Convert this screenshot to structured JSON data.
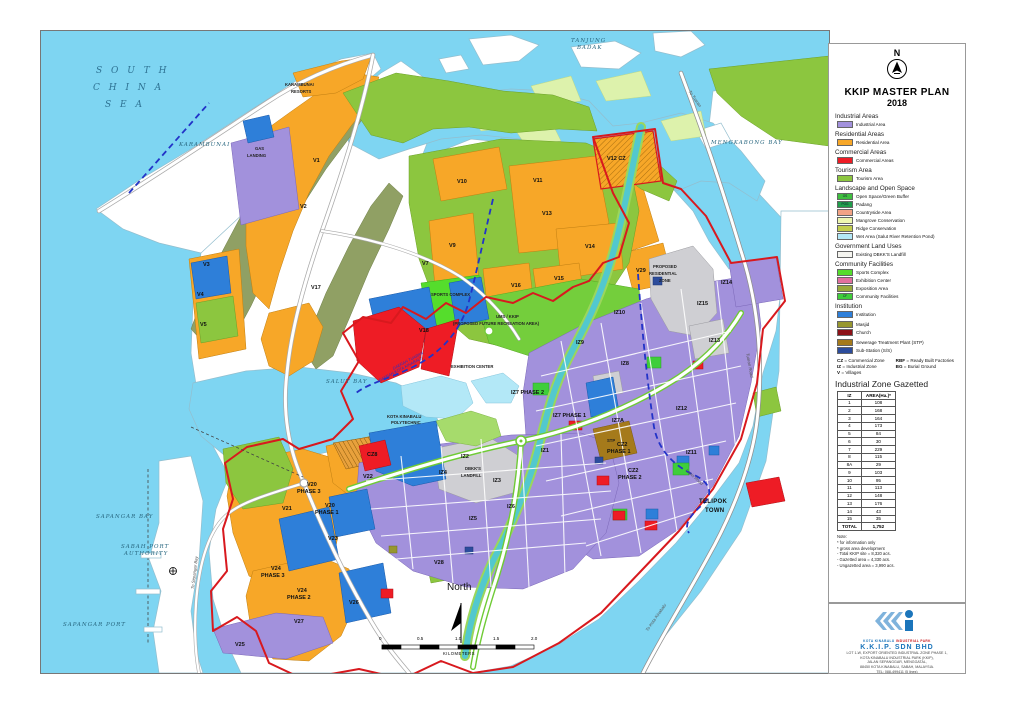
{
  "legend": {
    "compass_letter": "N",
    "title": "KKIP MASTER PLAN",
    "year": "2018",
    "groups": [
      {
        "heading": "Industrial Areas",
        "items": [
          {
            "label": "Industrial Area",
            "color": "#A291DC"
          }
        ]
      },
      {
        "heading": "Residential Areas",
        "items": [
          {
            "label": "Residential Area",
            "color": "#F7A728"
          }
        ]
      },
      {
        "heading": "Commercial Areas",
        "items": [
          {
            "label": "Commercial Areas",
            "color": "#EE1C25"
          }
        ]
      },
      {
        "heading": "Tourism Area",
        "items": [
          {
            "label": "Tourism Area",
            "color": "#8CC63F"
          }
        ]
      },
      {
        "heading": "Landscape and Open Space",
        "items": [
          {
            "label": "Open Space/Green Buffer",
            "color": "#3FBF3F",
            "tag": "OS"
          },
          {
            "label": "Padang",
            "color": "#1F9E4B",
            "tag": "POG"
          },
          {
            "label": "Countryside Area",
            "color": "#F2A385"
          },
          {
            "label": "Mangrove Conservation",
            "color": "#EDF6B0"
          },
          {
            "label": "Ridge Conservation",
            "color": "#C2CE4E"
          },
          {
            "label": "Wet Area (Salut River Retention Pond)",
            "color": "#B3E8F7"
          }
        ]
      },
      {
        "heading": "Government Land Uses",
        "items": [
          {
            "label": "Existing DBKK'S Landfill",
            "color": "#F5F5F0"
          }
        ]
      },
      {
        "heading": "Community Facilities",
        "items": [
          {
            "label": "Sports Complex",
            "color": "#55DD2C"
          },
          {
            "label": "Exhibition Center",
            "color": "#E2709F"
          },
          {
            "label": "Exposition Area",
            "color": "#9AA93C"
          },
          {
            "label": "Community Facilities",
            "color": "#3FCE3A",
            "tag": "CF"
          }
        ]
      },
      {
        "heading": "Institution",
        "items": [
          {
            "label": "Institution",
            "color": "#2E7FD9"
          }
        ]
      },
      {
        "heading": "",
        "items": [
          {
            "label": "Masjid",
            "color": "#97972F"
          },
          {
            "label": "Church",
            "color": "#8C1117"
          }
        ]
      },
      {
        "heading": "",
        "items": [
          {
            "label": "Sewerage Treatment Plant (STP)",
            "color": "#A57A1B"
          },
          {
            "label": "Sub-Station (S/S)",
            "color": "#2C4C9C"
          }
        ]
      }
    ],
    "abbreviations": [
      {
        "abbr": "CZ",
        "meaning": "Commercial Zone"
      },
      {
        "abbr": "IZ",
        "meaning": "Industrial Zone"
      },
      {
        "abbr": "V",
        "meaning": "Villages"
      },
      {
        "abbr": "RBF",
        "meaning": "Ready Built Factories"
      },
      {
        "abbr": "BG",
        "meaning": "Burial Ground"
      }
    ]
  },
  "table": {
    "title": "Industrial Zone Gazetted",
    "columns": [
      "IZ",
      "AREA(Ha.)*"
    ],
    "rows": [
      [
        "1",
        "108"
      ],
      [
        "2",
        "168"
      ],
      [
        "3",
        "164"
      ],
      [
        "4",
        "173"
      ],
      [
        "5",
        "84"
      ],
      [
        "6",
        "30"
      ],
      [
        "7",
        "229"
      ],
      [
        "8",
        "115"
      ],
      [
        "8A",
        "29"
      ],
      [
        "9",
        "103"
      ],
      [
        "10",
        "95"
      ],
      [
        "11",
        "113"
      ],
      [
        "12",
        "148"
      ],
      [
        "13",
        "176"
      ],
      [
        "14",
        "43"
      ],
      [
        "15",
        "35"
      ]
    ],
    "total_label": "TOTAL",
    "total_value": "1,752"
  },
  "notes": [
    "Note:",
    "* for information only",
    "* gross area development",
    "- Total KKIP site = 8,320 acs.",
    "- Gazetted area = 4,330 acs.",
    "- Ungazetted area = 3,990 acs."
  ],
  "logo_box": {
    "logo_caption_1": "KOTA KINABALU",
    "logo_caption_2": "INDUSTRIAL PARK",
    "company": "K.K.I.P. SDN BHD",
    "address_lines": [
      "LOT 1-W, EXPORT ORIENTED INDUSTRIAL ZONE PHASE 1,",
      "KOTA KINABALU INDUSTRIAL PARK (KKIP),",
      "JALAN SEPANGGAR, MENGGATAL,",
      "88450 KOTA KINABALU, SABAH, MALAYSIA.",
      "TEL: 088-499411 (5 lines)",
      "UPDATE 24 NOVEMBER 2017"
    ]
  },
  "map": {
    "scalebar": {
      "ticks": [
        "0",
        "0.5",
        "1.0",
        "1.5",
        "2.0"
      ],
      "caption": "KILOMETERS"
    },
    "labels": [
      [
        "sea-big",
        "S O U T H",
        55,
        36
      ],
      [
        "sea-big",
        "C H I N A",
        52,
        53
      ],
      [
        "sea-big",
        "S E A",
        64,
        70
      ],
      [
        "sea",
        "TANJUNG",
        530,
        8
      ],
      [
        "sea",
        "BADAK",
        536,
        15
      ],
      [
        "sea",
        "KARAMBUNAI",
        138,
        112
      ],
      [
        "sea",
        "MENGKABONG BAY",
        670,
        110
      ],
      [
        "sea",
        "SAPANGAR BAY",
        55,
        484
      ],
      [
        "sea",
        "SABAH PORT",
        80,
        514
      ],
      [
        "sea",
        "AUTHORITY",
        83,
        521
      ],
      [
        "sea",
        "SAPANGAR PORT",
        22,
        592
      ],
      [
        "sea",
        "SALUT BAY",
        285,
        349
      ],
      [
        "geo-b",
        "TELIPOK",
        658,
        468
      ],
      [
        "geo-b",
        "TOWN",
        664,
        477
      ],
      [
        "north",
        "North",
        406,
        552
      ],
      [
        "zone",
        "V1",
        272,
        128
      ],
      [
        "zone",
        "V2",
        259,
        174
      ],
      [
        "zone",
        "V3",
        162,
        232
      ],
      [
        "zone",
        "V4",
        156,
        262
      ],
      [
        "zone",
        "V5",
        159,
        292
      ],
      [
        "zone",
        "V7",
        381,
        231
      ],
      [
        "zone",
        "V9",
        408,
        213
      ],
      [
        "zone",
        "V10",
        416,
        149
      ],
      [
        "zone",
        "V11",
        492,
        148
      ],
      [
        "zone",
        "V12 CZ",
        566,
        126
      ],
      [
        "zone",
        "V13",
        501,
        181
      ],
      [
        "zone",
        "V14",
        544,
        214
      ],
      [
        "zone",
        "V15",
        513,
        246
      ],
      [
        "zone",
        "V16",
        470,
        253
      ],
      [
        "zone",
        "V17",
        270,
        255
      ],
      [
        "zone",
        "V18",
        378,
        298
      ],
      [
        "zone",
        "V20",
        266,
        452
      ],
      [
        "zone",
        "PHASE 3",
        256,
        459
      ],
      [
        "zone",
        "V20",
        284,
        473
      ],
      [
        "zone",
        "PHASE 1",
        274,
        480
      ],
      [
        "zone",
        "V21",
        241,
        476
      ],
      [
        "zone",
        "V22",
        322,
        444
      ],
      [
        "zone",
        "V23",
        287,
        506
      ],
      [
        "zone",
        "V24",
        230,
        536
      ],
      [
        "zone",
        "PHASE 3",
        220,
        543
      ],
      [
        "zone",
        "V24",
        256,
        558
      ],
      [
        "zone",
        "PHASE 2",
        246,
        565
      ],
      [
        "zone",
        "V25",
        194,
        612
      ],
      [
        "zone",
        "V26",
        308,
        570
      ],
      [
        "zone",
        "V27",
        253,
        589
      ],
      [
        "zone",
        "V28",
        393,
        530
      ],
      [
        "zone",
        "V29",
        595,
        238
      ],
      [
        "zone",
        "IZ8",
        580,
        331
      ],
      [
        "zone",
        "IZ9",
        535,
        310
      ],
      [
        "zone",
        "IZ10",
        573,
        280
      ],
      [
        "zone",
        "IZ11",
        645,
        420
      ],
      [
        "zone",
        "IZ12",
        635,
        376
      ],
      [
        "zone",
        "IZ13",
        668,
        308
      ],
      [
        "zone",
        "IZ14",
        680,
        250
      ],
      [
        "zone",
        "IZ15",
        656,
        271
      ],
      [
        "zone",
        "IZ7 PHASE 2",
        470,
        360
      ],
      [
        "zone",
        "IZ7 PHASE 1",
        512,
        383
      ],
      [
        "zone",
        "IZ7A",
        571,
        388
      ],
      [
        "zone",
        "CZ2",
        576,
        412
      ],
      [
        "zone",
        "PHASE 1",
        566,
        419
      ],
      [
        "zone",
        "CZ2",
        587,
        438
      ],
      [
        "zone",
        "PHASE 2",
        577,
        445
      ],
      [
        "zone",
        "IZ1",
        500,
        418
      ],
      [
        "zone",
        "IZ2",
        420,
        424
      ],
      [
        "zone",
        "IZ3",
        452,
        448
      ],
      [
        "zone",
        "IZ4",
        398,
        440
      ],
      [
        "zone",
        "IZ5",
        428,
        486
      ],
      [
        "zone",
        "IZ6",
        466,
        474
      ],
      [
        "zone",
        "CZ8",
        326,
        422
      ],
      [
        "fac",
        "SPORTS COMPLEX",
        390,
        262
      ],
      [
        "fac",
        "EXHIBITION CENTER",
        410,
        334
      ],
      [
        "fac",
        "KOTA KINABALU",
        346,
        384
      ],
      [
        "fac",
        "POLYTECHNIC",
        350,
        390
      ],
      [
        "fac",
        "UMS / KKIP",
        455,
        284
      ],
      [
        "fac",
        "(PROPOSED FUTURE RECREATION AREA)",
        412,
        291
      ],
      [
        "fac",
        "PROPOSED",
        612,
        234
      ],
      [
        "fac",
        "RESIDENTIAL",
        608,
        241
      ],
      [
        "fac",
        "ZONE",
        618,
        248
      ],
      [
        "fac",
        "KARAMBUNAI",
        244,
        52
      ],
      [
        "fac",
        "RESORTS",
        250,
        59
      ],
      [
        "fac",
        "GAS",
        214,
        116
      ],
      [
        "fac",
        "LANDING",
        206,
        123
      ],
      [
        "fac",
        "DBKK'S",
        424,
        436
      ],
      [
        "fac",
        "LANDFILL",
        420,
        443
      ],
      [
        "fac",
        "STP",
        566,
        408
      ],
      [
        "road",
        "To Tuaran",
        648,
        58,
        55
      ],
      [
        "road",
        "To Kota Kinabalu",
        606,
        598,
        -55
      ],
      [
        "road",
        "To Sepangar Bay",
        152,
        556,
        -83
      ],
      [
        "road",
        "Lapis Road",
        645,
        437,
        42
      ],
      [
        "road",
        "Tuaran Road",
        706,
        320,
        80
      ],
      [
        "bnd",
        "DAERAH TUARAN",
        352,
        336,
        -28
      ],
      [
        "bnd",
        "DAERAH KOTA KINABALU",
        338,
        348,
        -28
      ]
    ]
  }
}
